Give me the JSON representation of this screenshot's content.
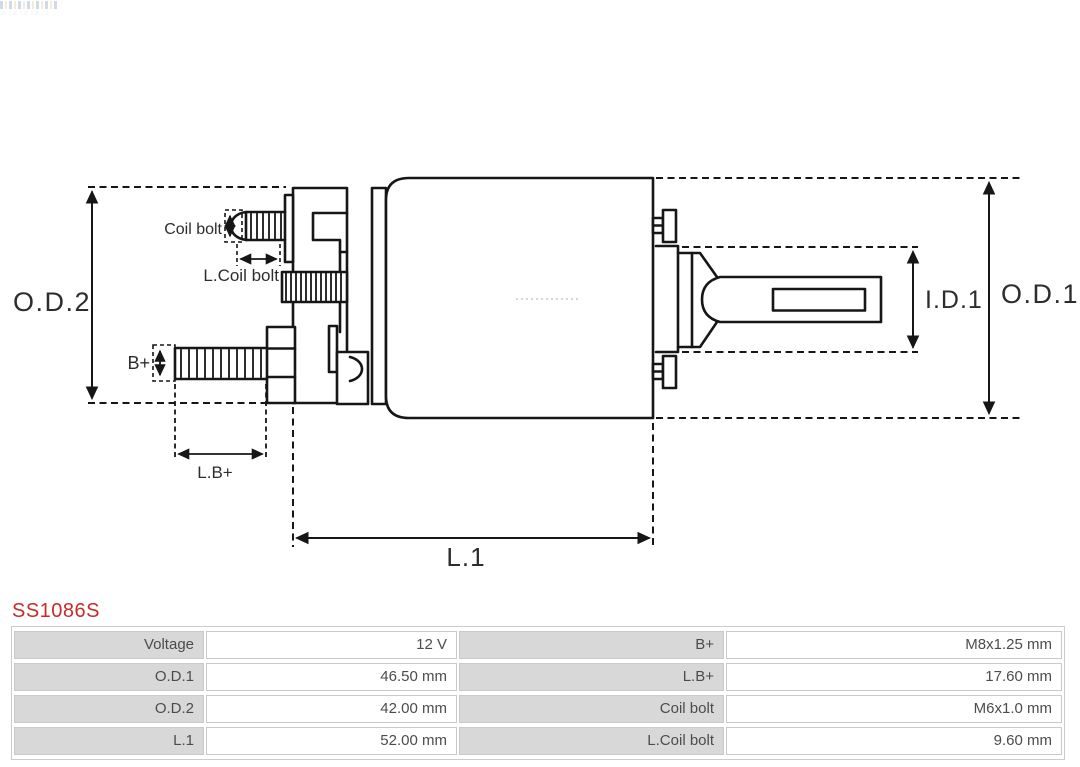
{
  "part": {
    "number": "SS1086S",
    "accent_color": "#c92a2a"
  },
  "diagram": {
    "line_color": "#161616",
    "labels": {
      "od2": "O.D.2",
      "od1": "O.D.1",
      "id1": "I.D.1",
      "l1": "L.1",
      "lb_plus": "L.B+",
      "b_plus": "B+",
      "coil_bolt": "Coil bolt",
      "l_coil_bolt": "L.Coil bolt"
    }
  },
  "spec_table": {
    "label_bg": "#d8d8d8",
    "value_bg": "#ffffff",
    "rows": [
      {
        "label1": "Voltage",
        "value1": "12 V",
        "label2": "B+",
        "value2": "M8x1.25 mm"
      },
      {
        "label1": "O.D.1",
        "value1": "46.50 mm",
        "label2": "L.B+",
        "value2": "17.60 mm"
      },
      {
        "label1": "O.D.2",
        "value1": "42.00 mm",
        "label2": "Coil bolt",
        "value2": "M6x1.0 mm"
      },
      {
        "label1": "L.1",
        "value1": "52.00 mm",
        "label2": "L.Coil bolt",
        "value2": "9.60 mm"
      }
    ]
  }
}
